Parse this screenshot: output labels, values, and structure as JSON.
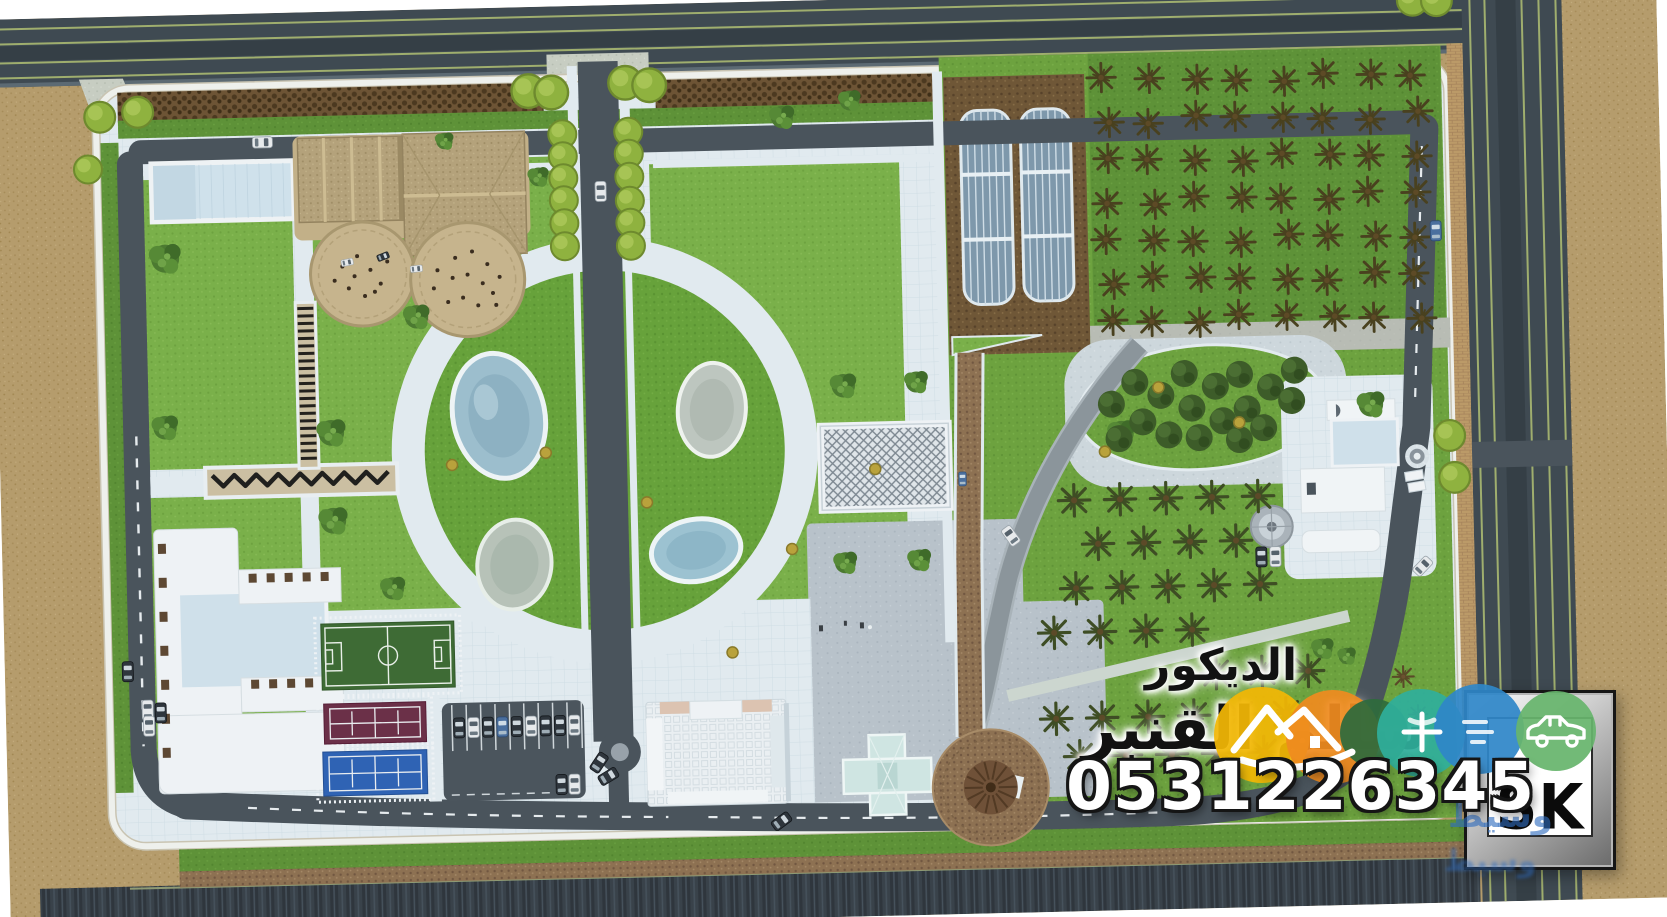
{
  "watermark": {
    "title_line": "الديكور",
    "name_line": "سالم القنبر",
    "phone": "0531226345",
    "logo_text": "SK",
    "overlay_text": "وسيط",
    "badges": [
      {
        "name": "mountain-badge-yellow",
        "color": "#f2b705"
      },
      {
        "name": "mountain-badge-orange",
        "color": "#ef8b1f"
      },
      {
        "name": "leaf-badge-darkgreen",
        "color": "#2e6b3c"
      },
      {
        "name": "plus-badge-teal",
        "color": "#2fae9b"
      },
      {
        "name": "text-badge-blue",
        "color": "#2f86c8"
      },
      {
        "name": "car-badge-green",
        "color": "#67b56d"
      }
    ]
  },
  "palette": {
    "sand": "#b59c6c",
    "asphalt": "#46525a",
    "lane_line": "#9fae6e",
    "lawn": "#6da23f",
    "lawn_light": "#7ab04a",
    "lawn_dark": "#5e9238",
    "path_white": "#e1eaef",
    "wall": "#eef0ec",
    "pond_blue": "#9cbecd",
    "pond_gray": "#bdc6bf",
    "soil": "#6f5737",
    "gravel": "#8d7152",
    "hedge": "#6d5435",
    "football_green": "#3e6b35",
    "court_maroon": "#6b3048",
    "court_blue": "#2f63b4",
    "greenhouse_glass": "#7e98ab",
    "plaza_gray": "#b8c2ca",
    "palm_dark": "#3c4423",
    "roof_tan": "#b4a27b"
  }
}
